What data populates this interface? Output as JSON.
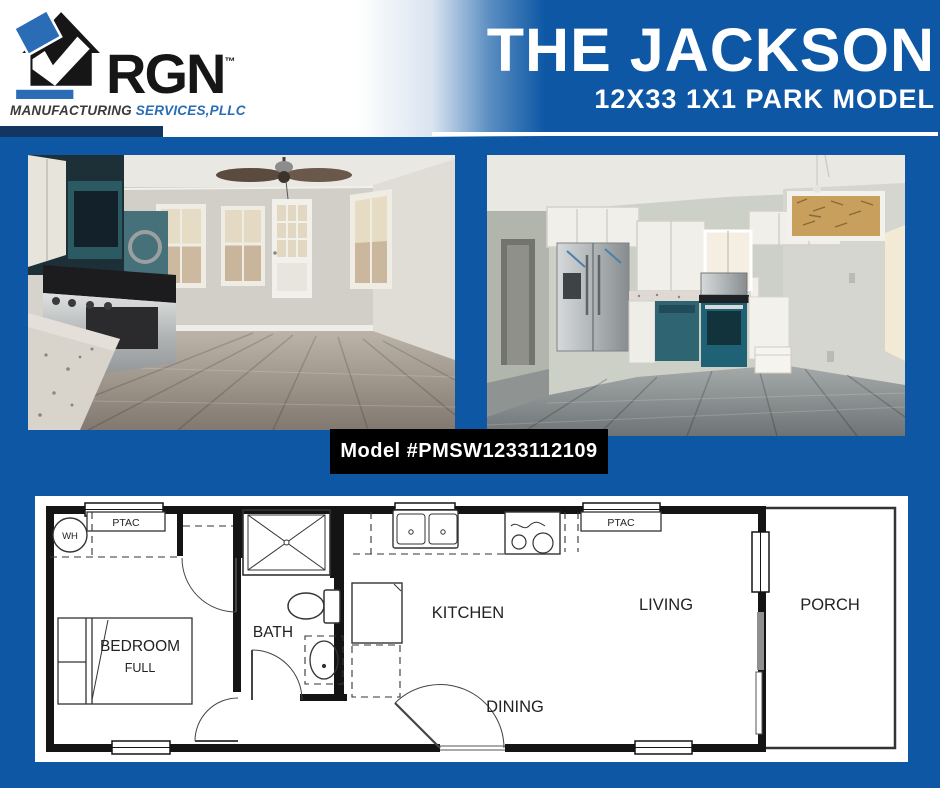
{
  "header": {
    "logo": {
      "brand": "RGN",
      "tm": "™",
      "tagline_1": "MANUFACTURING ",
      "tagline_2": "SERVICES,PLLC"
    },
    "title": "THE JACKSON",
    "subtitle": "12X33 1X1 PARK MODEL"
  },
  "badge": {
    "model_label": "Model #PMSW1233112109"
  },
  "floorplan": {
    "labels": {
      "wh": "WH",
      "ptac_left": "PTAC",
      "ptac_right": "PTAC",
      "bedroom": "BEDROOM",
      "bedroom_size": "FULL",
      "bath": "BATH",
      "kitchen": "KITCHEN",
      "dining": "DINING",
      "living": "LIVING",
      "porch": "PORCH"
    }
  },
  "colors": {
    "brand_blue": "#0d57a5",
    "navy_accent": "#12365f",
    "logo_blue": "#2a6cb5",
    "badge_bg": "#000000",
    "plan_line": "#1a1a1a",
    "plan_bg": "#ffffff"
  }
}
